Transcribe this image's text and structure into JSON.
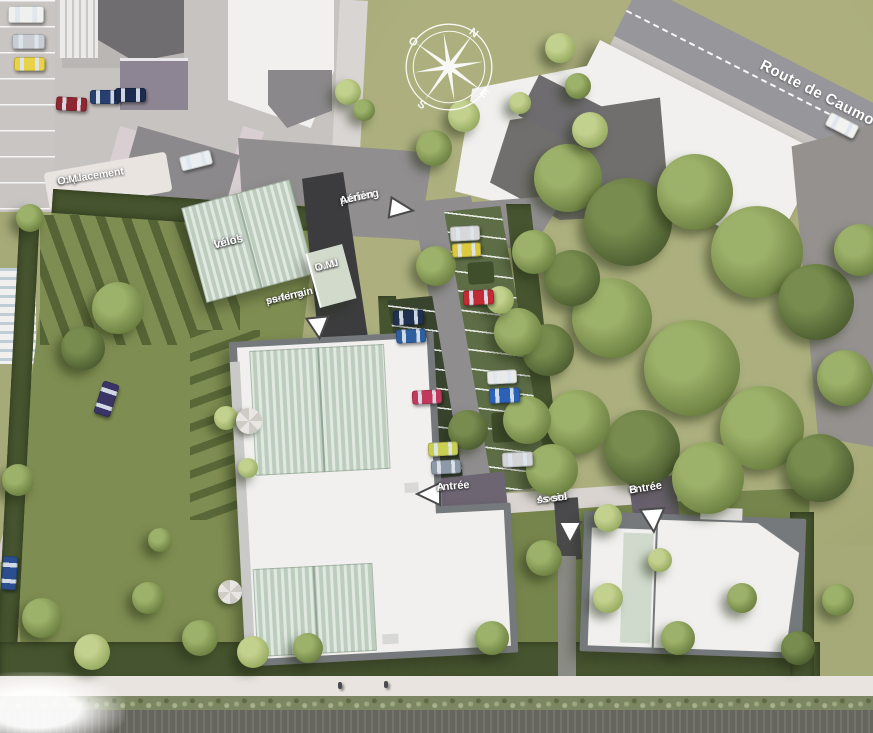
{
  "scene": {
    "title": "aerial residential site plan render",
    "labels": {
      "route": "Route de Caumont",
      "parking_aerien_1": "parking",
      "parking_aerien_2": "Aérien",
      "local_velos_1": "local",
      "local_velos_2": "vélos",
      "local_om_1": "local",
      "local_om_2": "O.M.",
      "parking_ss_1": "parking",
      "parking_ss_2": "ss-terrain",
      "emplacement_1": "emplacement",
      "emplacement_2": "O.M.",
      "entree_a_1": "entrée",
      "entree_a_2": "A",
      "entree_b_1": "entrée",
      "entree_b_2": "B",
      "acces_1": "Accès",
      "acces_2": "ss-sol"
    },
    "compass": {
      "n": "N",
      "e": "E",
      "s": "S",
      "o": "O"
    },
    "colors": {
      "lawn": "#a6aa78",
      "garden": "#7e8d51",
      "hedge": "#46542f",
      "road": "#97969a",
      "paving": "#908e8f",
      "lot": "#c7c3c0",
      "ramp_asphalt": "#3c3c3e",
      "roof_white": "#f1f0ee",
      "roof_mint": "#bccdbe",
      "label_text": "#ffffff",
      "arrow_fill": "#ffffff",
      "arrow_outline": "#4a4a4a"
    },
    "trees": [
      {
        "x": 568,
        "y": 178,
        "r": 34,
        "t": 2
      },
      {
        "x": 628,
        "y": 222,
        "r": 44,
        "t": 3
      },
      {
        "x": 695,
        "y": 192,
        "r": 38,
        "t": 2
      },
      {
        "x": 757,
        "y": 252,
        "r": 46,
        "t": 2
      },
      {
        "x": 816,
        "y": 302,
        "r": 38,
        "t": 3
      },
      {
        "x": 612,
        "y": 318,
        "r": 40,
        "t": 2
      },
      {
        "x": 692,
        "y": 368,
        "r": 48,
        "t": 2
      },
      {
        "x": 762,
        "y": 428,
        "r": 42,
        "t": 2
      },
      {
        "x": 642,
        "y": 448,
        "r": 38,
        "t": 3
      },
      {
        "x": 578,
        "y": 422,
        "r": 32,
        "t": 2
      },
      {
        "x": 708,
        "y": 478,
        "r": 36,
        "t": 2
      },
      {
        "x": 820,
        "y": 468,
        "r": 34,
        "t": 3
      },
      {
        "x": 845,
        "y": 378,
        "r": 28,
        "t": 2
      },
      {
        "x": 572,
        "y": 278,
        "r": 28,
        "t": 3
      },
      {
        "x": 534,
        "y": 252,
        "r": 22,
        "t": 2
      },
      {
        "x": 548,
        "y": 350,
        "r": 26,
        "t": 3
      },
      {
        "x": 527,
        "y": 420,
        "r": 24,
        "t": 2
      },
      {
        "x": 552,
        "y": 470,
        "r": 26,
        "t": 2
      },
      {
        "x": 860,
        "y": 250,
        "r": 26,
        "t": 2
      },
      {
        "x": 590,
        "y": 130,
        "r": 18,
        "t": 1
      },
      {
        "x": 560,
        "y": 48,
        "r": 15,
        "t": 1
      },
      {
        "x": 578,
        "y": 86,
        "r": 13,
        "t": 2
      },
      {
        "x": 520,
        "y": 103,
        "r": 11,
        "t": 1
      },
      {
        "x": 118,
        "y": 308,
        "r": 26,
        "t": 2
      },
      {
        "x": 83,
        "y": 348,
        "r": 22,
        "t": 3
      },
      {
        "x": 18,
        "y": 480,
        "r": 16,
        "t": 2
      },
      {
        "x": 42,
        "y": 618,
        "r": 20,
        "t": 2
      },
      {
        "x": 92,
        "y": 652,
        "r": 18,
        "t": 1
      },
      {
        "x": 148,
        "y": 598,
        "r": 16,
        "t": 2
      },
      {
        "x": 200,
        "y": 638,
        "r": 18,
        "t": 2
      },
      {
        "x": 253,
        "y": 652,
        "r": 16,
        "t": 1
      },
      {
        "x": 308,
        "y": 648,
        "r": 15,
        "t": 2
      },
      {
        "x": 492,
        "y": 638,
        "r": 17,
        "t": 2
      },
      {
        "x": 608,
        "y": 598,
        "r": 15,
        "t": 1
      },
      {
        "x": 678,
        "y": 638,
        "r": 17,
        "t": 2
      },
      {
        "x": 742,
        "y": 598,
        "r": 15,
        "t": 2
      },
      {
        "x": 798,
        "y": 648,
        "r": 17,
        "t": 3
      },
      {
        "x": 838,
        "y": 600,
        "r": 16,
        "t": 2
      },
      {
        "x": 436,
        "y": 266,
        "r": 20,
        "t": 2
      },
      {
        "x": 518,
        "y": 332,
        "r": 24,
        "t": 2
      },
      {
        "x": 468,
        "y": 430,
        "r": 20,
        "t": 3
      },
      {
        "x": 434,
        "y": 148,
        "r": 18,
        "t": 2
      },
      {
        "x": 464,
        "y": 116,
        "r": 16,
        "t": 1
      },
      {
        "x": 500,
        "y": 300,
        "r": 14,
        "t": 1
      },
      {
        "x": 544,
        "y": 558,
        "r": 18,
        "t": 2
      },
      {
        "x": 608,
        "y": 518,
        "r": 14,
        "t": 1
      },
      {
        "x": 660,
        "y": 560,
        "r": 12,
        "t": 1
      },
      {
        "x": 226,
        "y": 418,
        "r": 12,
        "t": 1
      },
      {
        "x": 248,
        "y": 468,
        "r": 10,
        "t": 1
      },
      {
        "x": 160,
        "y": 540,
        "r": 12,
        "t": 2
      },
      {
        "x": 30,
        "y": 218,
        "r": 14,
        "t": 2
      },
      {
        "x": 348,
        "y": 92,
        "r": 13,
        "t": 1
      },
      {
        "x": 364,
        "y": 110,
        "r": 11,
        "t": 2
      }
    ],
    "cars": [
      {
        "color": "#f0f0ee",
        "x": 8,
        "y": 6,
        "w": 36,
        "h": 17,
        "rot": 0
      },
      {
        "color": "#c9cdd2",
        "x": 12,
        "y": 34,
        "w": 33,
        "h": 15,
        "rot": 0
      },
      {
        "color": "#e8d24a",
        "x": 14,
        "y": 57,
        "w": 31,
        "h": 14,
        "rot": 0
      },
      {
        "color": "#8f2730",
        "x": 56,
        "y": 97,
        "w": 31,
        "h": 14,
        "rot": 3
      },
      {
        "color": "#27406e",
        "x": 90,
        "y": 90,
        "w": 30,
        "h": 14,
        "rot": 0
      },
      {
        "color": "#1d2c4e",
        "x": 115,
        "y": 88,
        "w": 31,
        "h": 14,
        "rot": 0
      },
      {
        "color": "#eceff0",
        "x": 180,
        "y": 153,
        "w": 32,
        "h": 15,
        "rot": -14
      },
      {
        "color": "#3a3566",
        "x": 98,
        "y": 382,
        "w": 17,
        "h": 34,
        "rot": 18
      },
      {
        "color": "#2b4f8e",
        "x": 2,
        "y": 556,
        "w": 15,
        "h": 34,
        "rot": 4
      },
      {
        "color": "#d8d8da",
        "x": 450,
        "y": 226,
        "w": 30,
        "h": 15,
        "rot": -3
      },
      {
        "color": "#ddc93e",
        "x": 452,
        "y": 243,
        "w": 29,
        "h": 14,
        "rot": -3
      },
      {
        "color": "#c22a35",
        "x": 463,
        "y": 290,
        "w": 31,
        "h": 15,
        "rot": -3
      },
      {
        "color": "#e9eaea",
        "x": 487,
        "y": 370,
        "w": 30,
        "h": 14,
        "rot": -3
      },
      {
        "color": "#2b62b8",
        "x": 489,
        "y": 388,
        "w": 31,
        "h": 15,
        "rot": -3
      },
      {
        "color": "#d3d4d6",
        "x": 502,
        "y": 452,
        "w": 31,
        "h": 15,
        "rot": -3
      },
      {
        "color": "#1f3050",
        "x": 393,
        "y": 310,
        "w": 31,
        "h": 15,
        "rot": -3
      },
      {
        "color": "#2e5f9e",
        "x": 396,
        "y": 329,
        "w": 30,
        "h": 14,
        "rot": -3
      },
      {
        "color": "#c2385c",
        "x": 412,
        "y": 390,
        "w": 30,
        "h": 14,
        "rot": -3
      },
      {
        "color": "#c9cf52",
        "x": 428,
        "y": 442,
        "w": 30,
        "h": 14,
        "rot": -3
      },
      {
        "color": "#8e99a8",
        "x": 431,
        "y": 460,
        "w": 30,
        "h": 14,
        "rot": -3
      },
      {
        "color": "#f2f2f0",
        "x": 826,
        "y": 118,
        "w": 32,
        "h": 15,
        "rot": 27
      }
    ],
    "people": [
      {
        "x": 338,
        "y": 682
      },
      {
        "x": 384,
        "y": 681
      }
    ]
  }
}
